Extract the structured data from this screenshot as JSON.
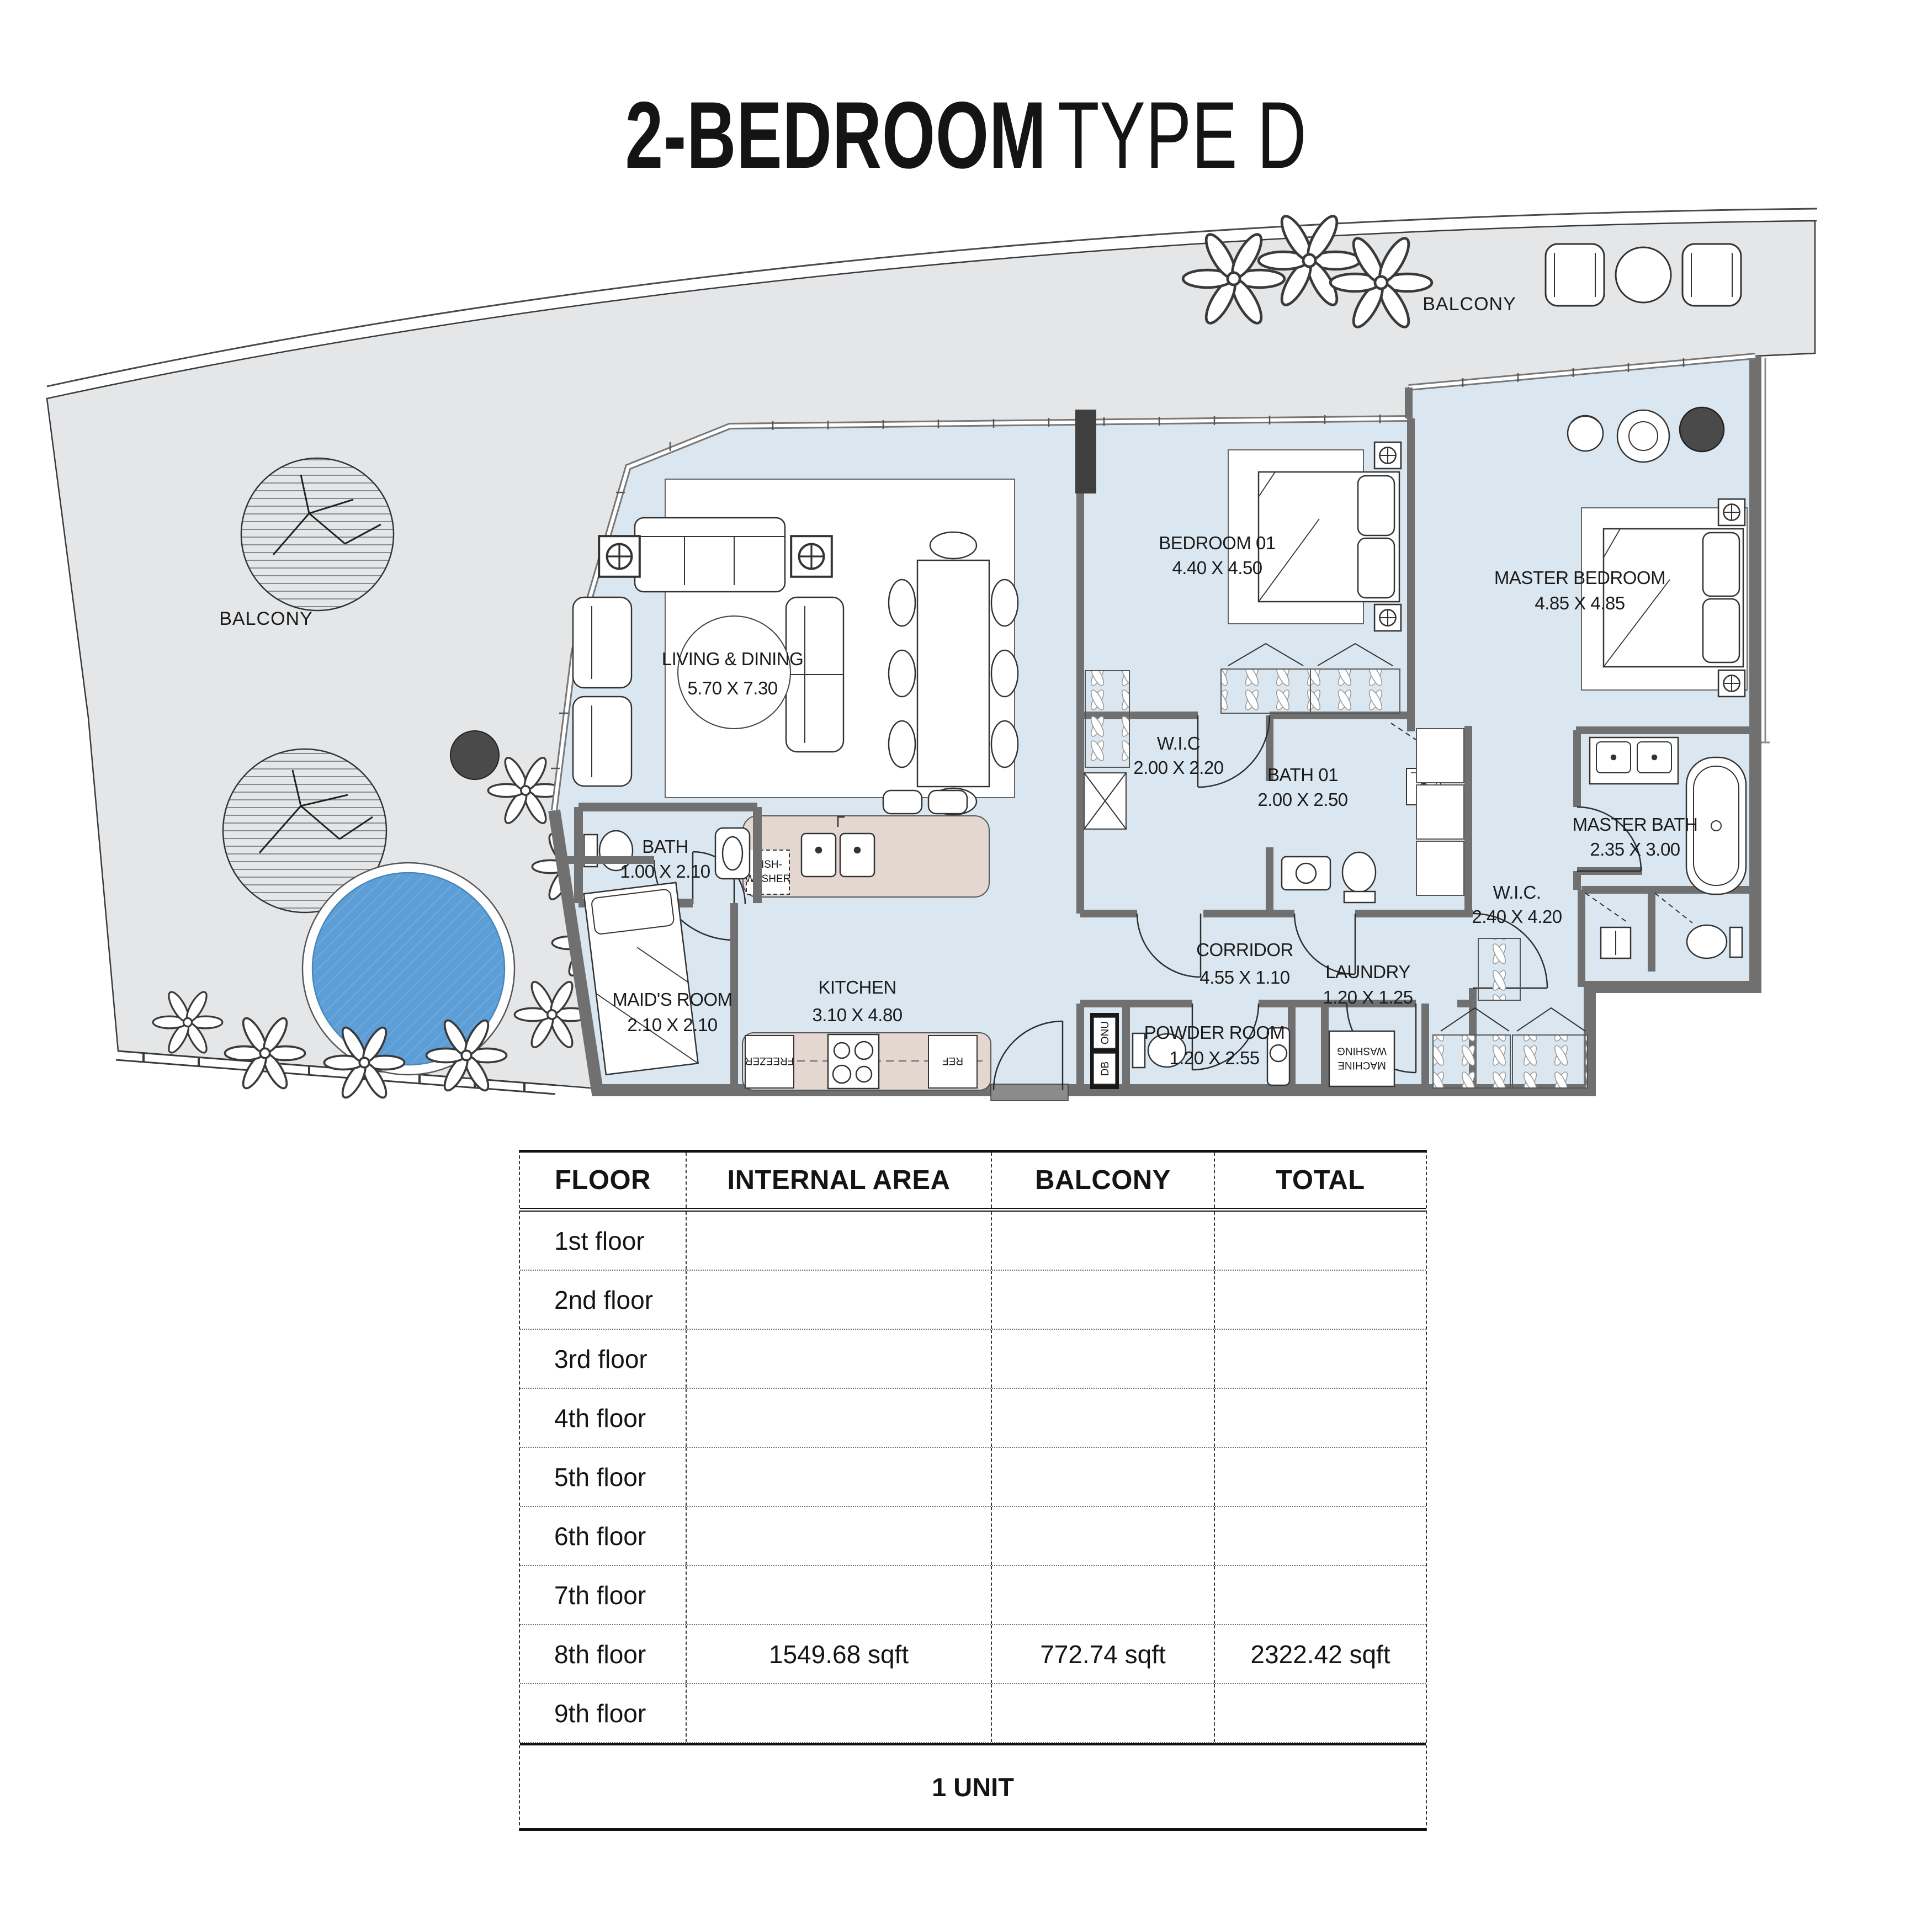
{
  "title": {
    "bold": "2-BEDROOM",
    "light": "TYPE D"
  },
  "plan": {
    "balcony_top_label": "BALCONY",
    "balcony_left_label": "BALCONY",
    "rooms": {
      "living": {
        "name": "LIVING & DINING",
        "dims": "5.70 X 7.30"
      },
      "kitchen": {
        "name": "KITCHEN",
        "dims": "3.10 X 4.80"
      },
      "bath": {
        "name": "BATH",
        "dims": "1.00 X 2.10"
      },
      "maids": {
        "name": "MAID'S ROOM",
        "dims": "2.10 X 2.10"
      },
      "bedroom01": {
        "name": "BEDROOM 01",
        "dims": "4.40 X 4.50"
      },
      "wic1": {
        "name": "W.I.C",
        "dims": "2.00 X 2.20"
      },
      "bath01": {
        "name": "BATH 01",
        "dims": "2.00 X 2.50"
      },
      "corridor": {
        "name": "CORRIDOR",
        "dims": "4.55 X 1.10"
      },
      "powder": {
        "name": "POWDER ROOM",
        "dims": "1.20 X 2.55"
      },
      "laundry": {
        "name": "LAUNDRY",
        "dims": "1.20 X 1.25"
      },
      "master_bedroom": {
        "name": "MASTER BEDROOM",
        "dims": "4.85 X 4.85"
      },
      "master_bath": {
        "name": "MASTER BATH",
        "dims": "2.35 X 3.00"
      },
      "wic2": {
        "name": "W.I.C.",
        "dims": "2.40 X 4.20"
      }
    },
    "appliances": {
      "dishwasher_line1": "DISH-",
      "dishwasher_line2": "WASHER",
      "freezer": "FREEZER",
      "ref": "REF",
      "washing_line1": "WASHING",
      "washing_line2": "MACHINE",
      "onu": "ONU",
      "db": "DB"
    }
  },
  "table": {
    "headers": [
      "FLOOR",
      "INTERNAL AREA",
      "BALCONY",
      "TOTAL"
    ],
    "rows": [
      {
        "floor": "1st floor",
        "internal": "",
        "balcony": "",
        "total": ""
      },
      {
        "floor": "2nd floor",
        "internal": "",
        "balcony": "",
        "total": ""
      },
      {
        "floor": "3rd floor",
        "internal": "",
        "balcony": "",
        "total": ""
      },
      {
        "floor": "4th floor",
        "internal": "",
        "balcony": "",
        "total": ""
      },
      {
        "floor": "5th floor",
        "internal": "",
        "balcony": "",
        "total": ""
      },
      {
        "floor": "6th floor",
        "internal": "",
        "balcony": "",
        "total": ""
      },
      {
        "floor": "7th floor",
        "internal": "",
        "balcony": "",
        "total": ""
      },
      {
        "floor": "8th floor",
        "internal": "1549.68 sqft",
        "balcony": "772.74 sqft",
        "total": "2322.42 sqft"
      },
      {
        "floor": "9th floor",
        "internal": "",
        "balcony": "",
        "total": ""
      }
    ],
    "footer": "1 UNIT"
  },
  "colors": {
    "interior_floor": "#dbe7f0",
    "balcony_floor": "#e5e6e8",
    "wall_gray": "#707070",
    "wall_dark": "#3f3f3f",
    "counter_beige": "#e4d7cf",
    "pool_blue": "#5d9ed6",
    "line_dark": "#2a2a2a",
    "text": "#141414"
  }
}
